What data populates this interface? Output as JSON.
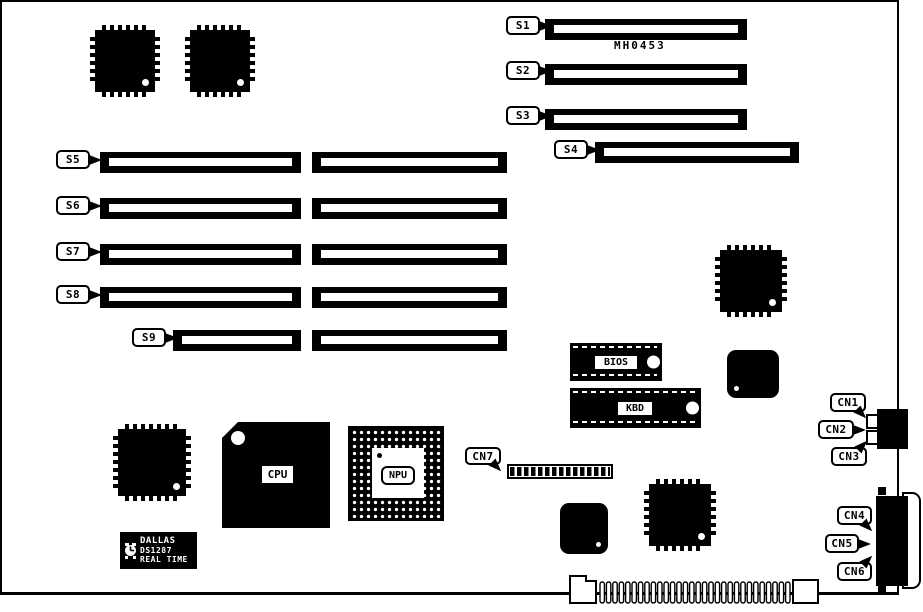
{
  "diagram": {
    "part_number": "MH0453",
    "colors": {
      "ink": "#000000",
      "paper": "#ffffff"
    },
    "slots": [
      {
        "id": "S1"
      },
      {
        "id": "S2"
      },
      {
        "id": "S3"
      },
      {
        "id": "S4"
      },
      {
        "id": "S5"
      },
      {
        "id": "S6"
      },
      {
        "id": "S7"
      },
      {
        "id": "S8"
      },
      {
        "id": "S9"
      }
    ],
    "connectors": [
      {
        "id": "CN1"
      },
      {
        "id": "CN2"
      },
      {
        "id": "CN3"
      },
      {
        "id": "CN4"
      },
      {
        "id": "CN5"
      },
      {
        "id": "CN6"
      },
      {
        "id": "CN7"
      }
    ],
    "chips": {
      "cpu_label": "CPU",
      "npu_label": "NPU",
      "bios_label": "BIOS",
      "kbd_label": "KBD",
      "rtc_brand": "DALLAS",
      "rtc_part": "DS1287",
      "rtc_type": "REAL TIME"
    },
    "bottom_edge": {
      "finger_count": 30
    }
  }
}
